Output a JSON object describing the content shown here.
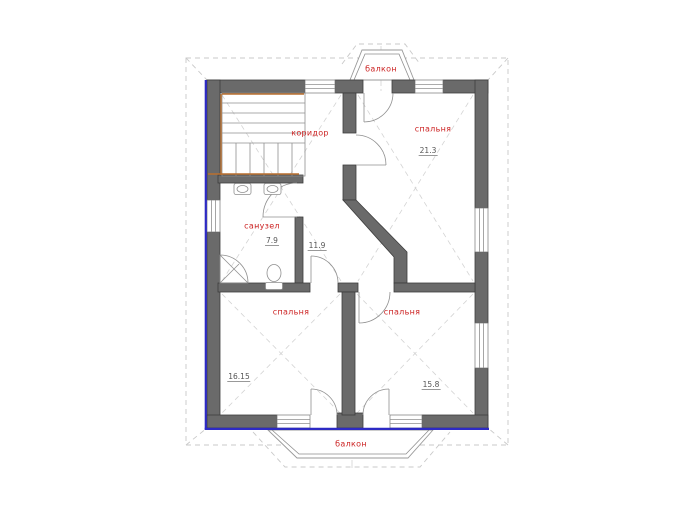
{
  "title": "Поэтажный план — 2 этаж",
  "colors": {
    "wall": "#6a6a6a",
    "facade_highlight": "#2d2ac4",
    "stair_highlight": "#b96f2e",
    "room_label": "#cc2323",
    "area_text": "#555555"
  },
  "rooms": [
    {
      "key": "balcony_top",
      "name": "балкон",
      "area": ""
    },
    {
      "key": "corridor",
      "name": "коридор",
      "area": "11.9"
    },
    {
      "key": "bedroom_top_right",
      "name": "спальня",
      "area": "21.3"
    },
    {
      "key": "bathroom",
      "name": "санузел",
      "area": "7.9"
    },
    {
      "key": "bedroom_bottom_left",
      "name": "спальня",
      "area": "16.15"
    },
    {
      "key": "bedroom_bottom_right",
      "name": "спальня",
      "area": "15.8"
    },
    {
      "key": "balcony_bottom",
      "name": "балкон",
      "area": ""
    }
  ]
}
